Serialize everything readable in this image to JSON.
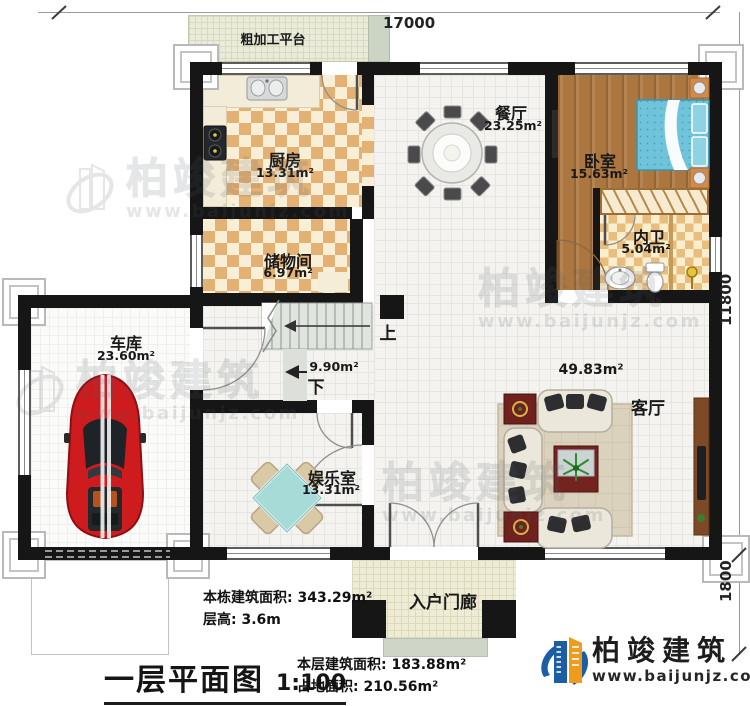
{
  "dimensions": {
    "top": "17000",
    "right_main": "11800",
    "right_porch": "1800"
  },
  "platform": {
    "label": "粗加工平台"
  },
  "rooms": {
    "kitchen": {
      "name": "厨房",
      "area": "13.31m²"
    },
    "dining": {
      "name": "餐厅",
      "area": "23.25m²"
    },
    "bedroom": {
      "name": "卧室",
      "area": "15.63m²"
    },
    "ensuite": {
      "name": "内卫",
      "area": "5.04m²"
    },
    "storage": {
      "name": "储物间",
      "area": "6.97m²"
    },
    "garage": {
      "name": "车库",
      "area": "23.60m²"
    },
    "recreation": {
      "name": "娱乐室",
      "area": "13.31m²"
    },
    "living": {
      "name": "客厅",
      "area": "49.83m²"
    },
    "porch": {
      "name": "入户门廊"
    }
  },
  "stairs": {
    "up": "上",
    "down": "下",
    "area": "9.90m²"
  },
  "annotations": {
    "building_total_area": "本栋建筑面积: 343.29m²",
    "floor_height": "层高: 3.6m",
    "floor_area": "本层建筑面积: 183.88m²",
    "footprint_area": "占地面积: 210.56m²"
  },
  "title_block": {
    "title": "一层平面图",
    "scale": "1:100"
  },
  "brand": {
    "company": "柏竣建筑",
    "website": "www.baijunjz.com"
  },
  "watermark": {
    "text": "柏竣建筑",
    "site": "www.baijunjz.com"
  },
  "colors": {
    "wall": "#161616",
    "checker": "#e3b174",
    "checker_light": "#f9efd6",
    "wood_floor": "#ab763f",
    "bed_blue": "#6fc3da",
    "car_red": "#ce1b1e",
    "brand_blue": "#1b5ea6",
    "brand_orange": "#ef9c1c",
    "stair_gray": "#e0e5e0"
  }
}
